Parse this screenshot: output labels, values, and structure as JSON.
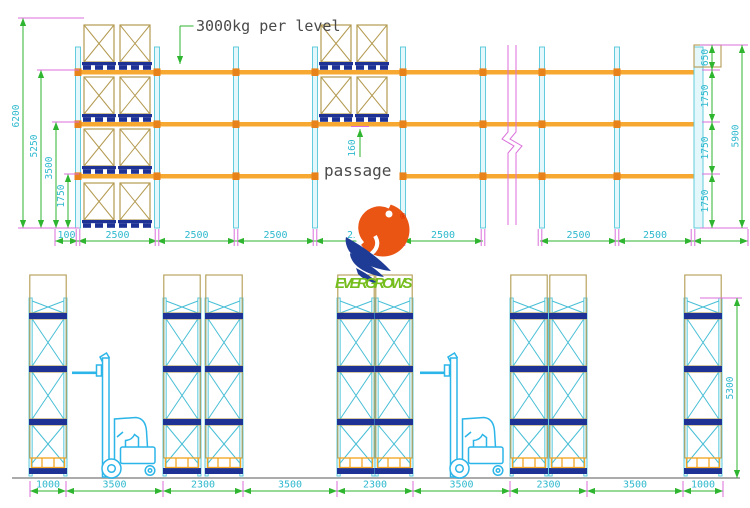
{
  "drawing": {
    "type": "pallet racking elevation drawing"
  },
  "colors": {
    "rack_post": "#53C6DB",
    "beam": "#F6A831",
    "beam_joint": "#E8821A",
    "load_box": "#B49B52",
    "pallet": "#1E3296",
    "dim_text": "#2FB9CE",
    "dim_line": "#2FB52F",
    "extension_line": "#DB6FDB",
    "annotation_text": "#4A4A4A",
    "ground": "#ABABAB",
    "forklift": "#2BB5E8",
    "logo_orange": "#EA5514",
    "logo_blue": "#1E3C96",
    "logo_green": "#76BE1E"
  },
  "top_view": {
    "load_label": "3000kg per level",
    "passage_label": "passage",
    "beam_height_dim": "160",
    "left_dims": [
      "6200",
      "5250",
      "3500",
      "1750"
    ],
    "right_dims": [
      "650",
      "1750",
      "1750",
      "1750"
    ],
    "right_total_dim": "5900",
    "bottom_dims": [
      "100",
      "2500",
      "2500",
      "2500",
      "2500",
      "2500",
      "2500",
      "2500"
    ]
  },
  "bottom_view": {
    "bottom_dims": [
      "1000",
      "3500",
      "2300",
      "3500",
      "2300",
      "3500",
      "2300",
      "3500",
      "1000"
    ],
    "height_dim": "5300"
  },
  "logo": {
    "brand": "EVERGROWS",
    "registered": "®"
  }
}
